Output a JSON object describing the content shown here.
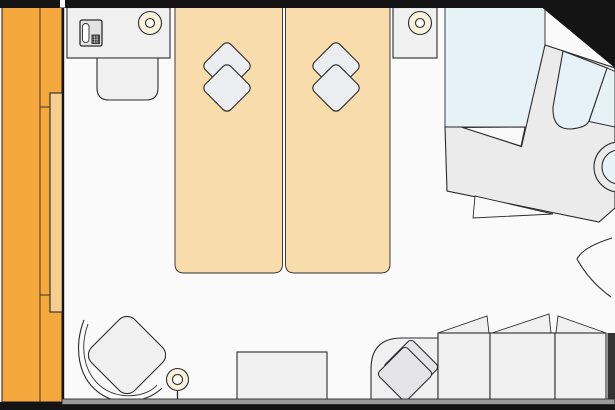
{
  "plan": {
    "kind": "cabin-floorplan",
    "canvas": {
      "width": 615,
      "height": 410
    },
    "furniture": [
      "balcony",
      "balcony-railing",
      "sliding-glass-door",
      "desk",
      "telephone",
      "desk-stool",
      "desk-chair",
      "bed-left",
      "bed-right",
      "bed-pillow",
      "nightstand",
      "nightstand-lamp",
      "shower-area",
      "bathtub",
      "toilet",
      "bathroom-counter",
      "bathroom-door",
      "sofa",
      "sofa-back-cushion",
      "sofa-pillow",
      "armchair",
      "floor-lamp",
      "coffee-table",
      "entrance-door-swing"
    ]
  },
  "colors": {
    "outline": "#2b2b2b",
    "wall_black": "#141414",
    "floor": "#fafafa",
    "bottom_wall": "#9b9b9b",
    "side_wall": "#333333",
    "balcony": "#f3a73c",
    "balcony_door": "#f6cf90",
    "bed": "#f8dcab",
    "pillow": "#ebedf0",
    "furniture": "#f0f0f0",
    "counter": "#ebebeb",
    "sofa_pillow": "#e4e4e7",
    "lamp": "#f6f2de",
    "lamp_inner": "#fdfcf4",
    "water": "#e7f1f8",
    "phone_body": "#e3e3e3",
    "phone_handset": "#ffffff",
    "phone_keypad": "#3c3c3c",
    "keypad_grid": "#cccccc"
  }
}
